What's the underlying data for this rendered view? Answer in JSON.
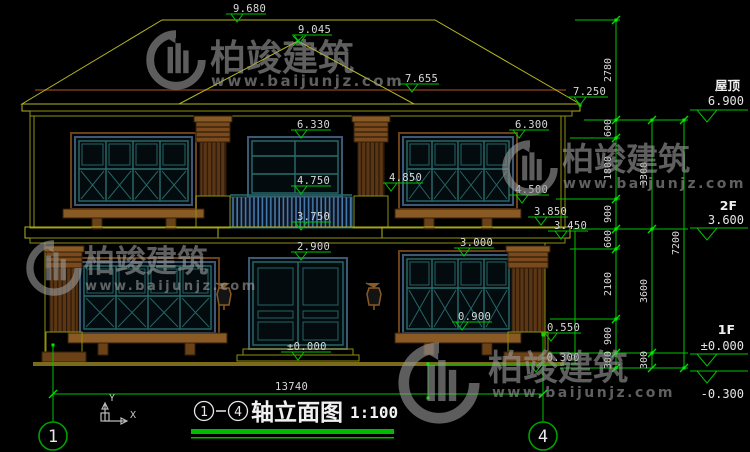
{
  "drawing": {
    "watermark": {
      "brand": "柏竣建筑",
      "url": "www.baijunjz.com"
    },
    "markers": [
      {
        "value": "9.680"
      },
      {
        "value": "9.045"
      },
      {
        "value": "7.655"
      },
      {
        "value": "7.250"
      },
      {
        "value": "6.330"
      },
      {
        "value": "6.300"
      },
      {
        "value": "4.750"
      },
      {
        "value": "4.850"
      },
      {
        "value": "4.500"
      },
      {
        "value": "3.750"
      },
      {
        "value": "3.850"
      },
      {
        "value": "3.450"
      },
      {
        "value": "2.900"
      },
      {
        "value": "3.000"
      },
      {
        "value": "0.900"
      },
      {
        "value": "0.550"
      },
      {
        "value": "-0.300"
      },
      {
        "value": "±0.000"
      }
    ],
    "levels": [
      {
        "label": "屋顶",
        "value": "6.900"
      },
      {
        "label": "2F",
        "value": "3.600"
      },
      {
        "label": "1F",
        "value": "±0.000"
      },
      {
        "label": "",
        "value": "-0.300"
      }
    ],
    "chains": {
      "inner": [
        "2780",
        "600",
        "1800",
        "900",
        "600",
        "2100",
        "900",
        "300"
      ],
      "middle": [
        "3300",
        "3600",
        "300"
      ],
      "outer": [
        "7200"
      ]
    },
    "ground_dimension": "13740",
    "axis_bubbles": {
      "left": "1",
      "right": "4"
    },
    "title": {
      "axis_start": "1",
      "axis_end": "4",
      "name": "轴立面图",
      "scale": "1:100"
    },
    "ucs": {
      "x_label": "X",
      "y_label": "Y"
    }
  }
}
